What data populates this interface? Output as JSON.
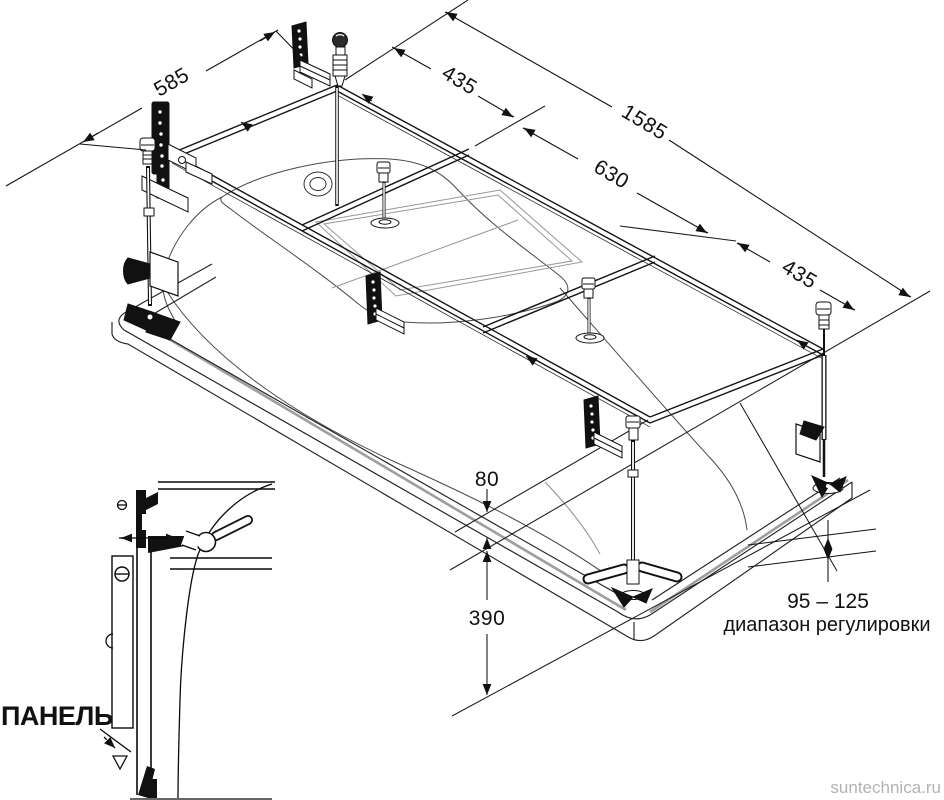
{
  "dims": {
    "d585": "585",
    "d435_left": "435",
    "d1585": "1585",
    "d630": "630",
    "d435_right": "435",
    "d80": "80",
    "d390": "390"
  },
  "annotation": {
    "range": "95 – 125",
    "caption": "диапазон регулировки"
  },
  "detail": {
    "panel_label": "ПАНЕЛЬ"
  },
  "watermark": "suntechnica.ru"
}
